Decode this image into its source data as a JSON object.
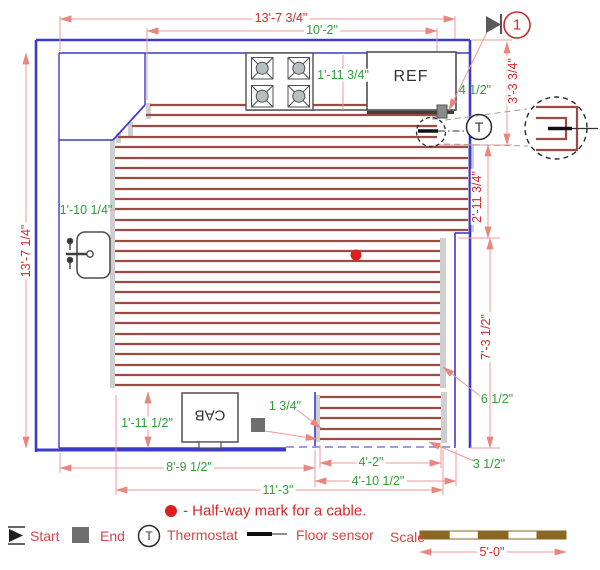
{
  "drawing": {
    "labels": {
      "ref": "REF",
      "cab": "CAB",
      "callout_number": "1",
      "thermostat_symbol": "T"
    },
    "dims": {
      "top_width": "13'-7 3/4\"",
      "top_counter_width": "10'-2\"",
      "left_height": "13'-7 1/4\"",
      "left_gap": "1'-10 1/4\"",
      "stove_ref_gap": "1'-11 3/4\"",
      "right_top": "3'-3 3/4\"",
      "right_mid": "2'-11 3/4\"",
      "right_bottom": "7'-3 1/2\"",
      "start_offset": "4 1/2\"",
      "right_cable_gap": "6 1/2\"",
      "bottom_cable_gap": "3 1/2\"",
      "bottom_left_width": "8'-9 1/2\"",
      "bottom_mid_width": "11'-3\"",
      "bottom_right_inner": "4'-2\"",
      "bottom_right_outer": "4'-10 1/2\"",
      "cab_gap": "1'-11 1/2\"",
      "end_offset": "1 3/4\""
    }
  },
  "legend": {
    "halfway": "- Half-way mark for a cable.",
    "start": "Start",
    "end": "End",
    "thermostat": "Thermostat",
    "thermostat_symbol": "T",
    "floor_sensor": "Floor sensor",
    "scale_label": "Scale",
    "scale_value": "5'-0\""
  },
  "colors": {
    "wall": "#3c3cc8",
    "opening_dashed": "#8f8fe8",
    "dim_line": "#ef9a9a",
    "dim_red_text": "#d42a2a",
    "dim_green_text": "#2f9e37",
    "cable": "#9b4b43",
    "shadow": "#cfcfcf",
    "appliance": "#4f4f4f",
    "scale_brown": "#8a6722",
    "legend_red": "#d84545",
    "halfway_dot": "#dc2020"
  },
  "cable": {
    "rows": [
      {
        "y": 105,
        "x1": 150,
        "x2": 441
      },
      {
        "y": 115,
        "x1": 146,
        "x2": 447
      },
      {
        "y": 126,
        "x1": 132,
        "x2": 437
      },
      {
        "y": 137,
        "x1": 118,
        "x2": 437
      },
      {
        "y": 147,
        "x1": 115,
        "x2": 468
      },
      {
        "y": 158,
        "x1": 115,
        "x2": 468
      },
      {
        "y": 168,
        "x1": 115,
        "x2": 468
      },
      {
        "y": 178,
        "x1": 115,
        "x2": 468
      },
      {
        "y": 189,
        "x1": 115,
        "x2": 468
      },
      {
        "y": 199,
        "x1": 115,
        "x2": 468
      },
      {
        "y": 209,
        "x1": 115,
        "x2": 468
      },
      {
        "y": 220,
        "x1": 115,
        "x2": 468
      },
      {
        "y": 230,
        "x1": 115,
        "x2": 468
      },
      {
        "y": 241,
        "x1": 115,
        "x2": 440
      },
      {
        "y": 251,
        "x1": 115,
        "x2": 440
      },
      {
        "y": 261,
        "x1": 115,
        "x2": 440
      },
      {
        "y": 272,
        "x1": 115,
        "x2": 440
      },
      {
        "y": 282,
        "x1": 115,
        "x2": 440
      },
      {
        "y": 292,
        "x1": 115,
        "x2": 440
      },
      {
        "y": 303,
        "x1": 115,
        "x2": 440
      },
      {
        "y": 313,
        "x1": 115,
        "x2": 440
      },
      {
        "y": 323,
        "x1": 115,
        "x2": 440
      },
      {
        "y": 334,
        "x1": 115,
        "x2": 440
      },
      {
        "y": 344,
        "x1": 115,
        "x2": 440
      },
      {
        "y": 354,
        "x1": 115,
        "x2": 440
      },
      {
        "y": 365,
        "x1": 115,
        "x2": 440
      },
      {
        "y": 375,
        "x1": 115,
        "x2": 440
      },
      {
        "y": 385,
        "x1": 115,
        "x2": 440
      },
      {
        "y": 397,
        "x1": 320,
        "x2": 441
      },
      {
        "y": 408,
        "x1": 320,
        "x2": 441
      },
      {
        "y": 418,
        "x1": 320,
        "x2": 441
      },
      {
        "y": 429,
        "x1": 320,
        "x2": 441
      },
      {
        "y": 439,
        "x1": 320,
        "x2": 441
      }
    ]
  }
}
